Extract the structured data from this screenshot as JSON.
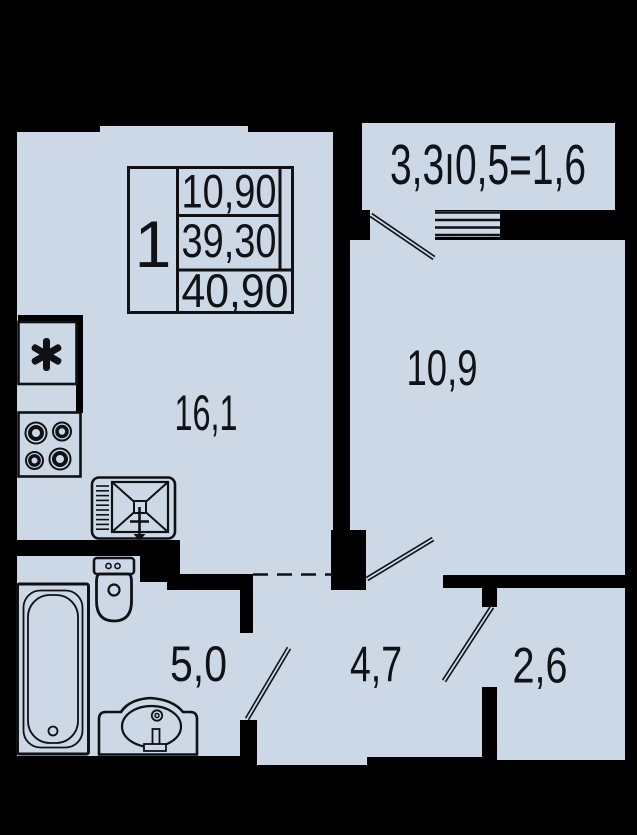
{
  "plan": {
    "type": "apartment-floor-plan",
    "colors": {
      "background": "#000000",
      "interior": "#ccd8e6",
      "walls": "#000000",
      "line": "#0f1114"
    },
    "info_table": {
      "rooms_count": "1",
      "living_area": "10,90",
      "area": "39,30",
      "total_area": "40,90"
    },
    "rooms": {
      "balcony_formula": "3,3ı0,5=1,6",
      "kitchen_living": "16,1",
      "bedroom": "10,9",
      "bathroom": "5,0",
      "hallway": "4,7",
      "wardrobe": "2,6"
    },
    "fixtures": {
      "shaft_symbol": "star-asterisk",
      "kitchen": [
        "stove-four-burners",
        "kitchen-sink-with-drainboard"
      ],
      "bathroom": [
        "toilet",
        "bathtub",
        "washbasin"
      ],
      "openings": [
        "balcony-window",
        "balcony-door-swing",
        "room-door-swing",
        "bathroom-door-swing",
        "wardrobe-door-swing",
        "open-passage-dashed"
      ]
    }
  }
}
